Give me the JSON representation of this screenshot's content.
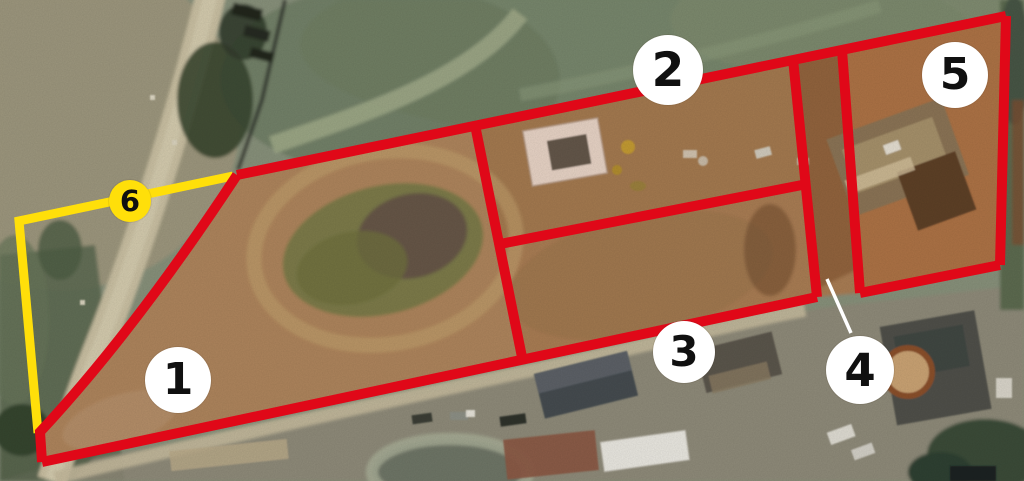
{
  "map": {
    "kind": "aerial-parcel-overlay",
    "markers": [
      {
        "label": "1",
        "style": "white"
      },
      {
        "label": "2",
        "style": "white"
      },
      {
        "label": "3",
        "style": "white"
      },
      {
        "label": "4",
        "style": "white",
        "has_leader_line": true
      },
      {
        "label": "5",
        "style": "white"
      },
      {
        "label": "6",
        "style": "yellow"
      }
    ],
    "colors": {
      "parcel_boundary": "#e00818",
      "highlight_boundary": "#ffdf0a",
      "marker_background": "#ffffff",
      "marker_highlight_background": "#ffdf0a",
      "marker_text": "#101010",
      "leader_line": "#ffffff"
    },
    "paths": {
      "outer_top": "M 237 175 L 1006 16",
      "outer_right": "M 1006 16 L 1000 265",
      "lot5_bottom": "M 1000 265 L 860 293",
      "lane_right": "M 842 50 L 860 293",
      "lane_left": "M 793 59 L 817 297",
      "outer_bottom": "M 42 462 L 817 297",
      "outer_left_curve": "M 237 175 Q 135 330 40 432 L 42 462",
      "divider_lot1": "M 475 125 L 523 362",
      "divider_lot2_lot3": "M 500 244 L 802 185",
      "yellow_boundary": "M 233 176 L 19 221 L 38 433",
      "leader_marker4": "M 827 279 L 851 333",
      "dirt_area": "M 237 175 Q 135 330 40 432 L 42 462 L 817 297 L 860 293 L 1000 265 L 1006 16 Z"
    }
  }
}
